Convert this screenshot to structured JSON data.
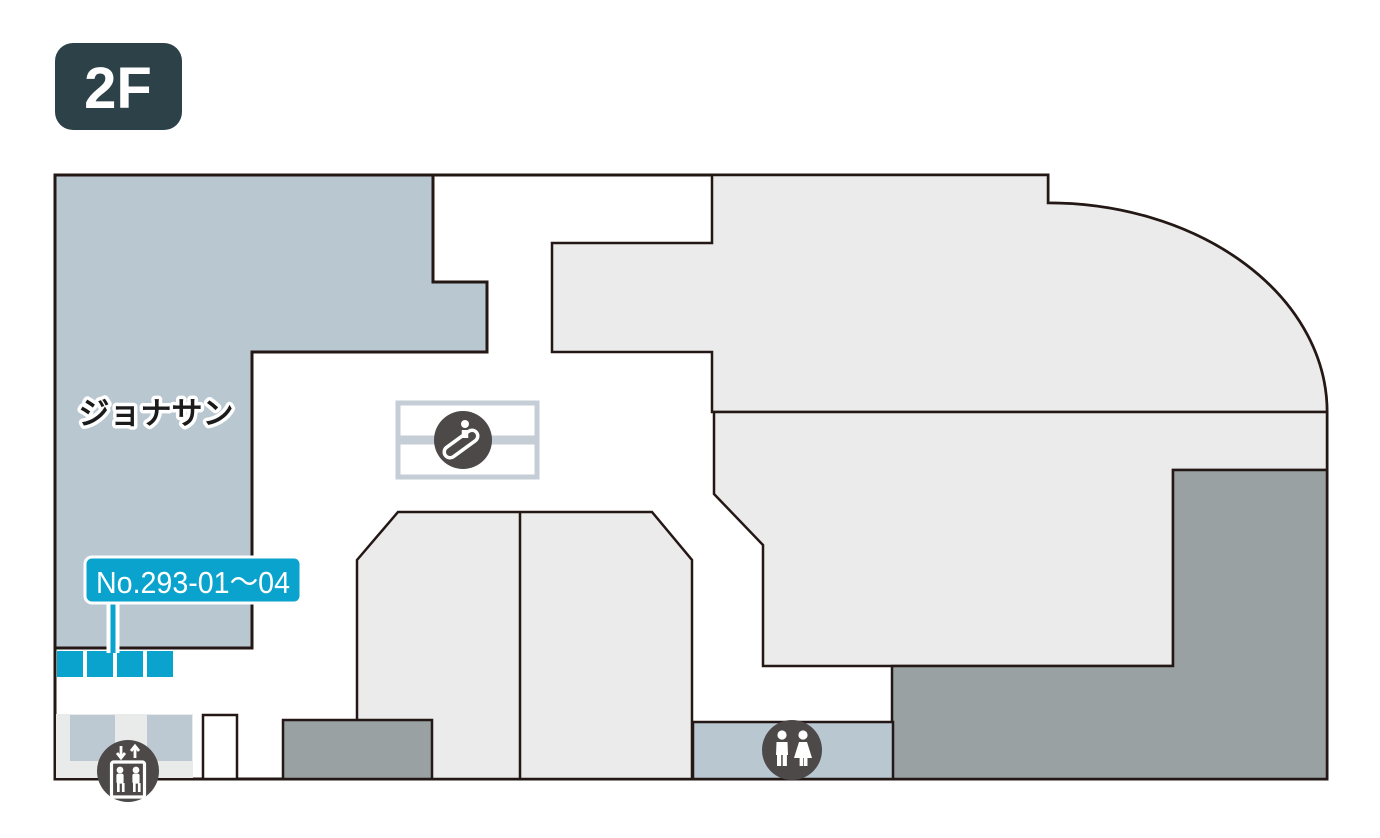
{
  "floor_badge": {
    "label": "2F"
  },
  "map": {
    "store_label": "ジョナサン",
    "unit_callout": "No.293-01〜04",
    "icons": [
      {
        "name": "escalator-icon",
        "meaning": "escalator"
      },
      {
        "name": "elevator-icon",
        "meaning": "elevator"
      },
      {
        "name": "restroom-icon",
        "meaning": "restroom"
      }
    ],
    "colors": {
      "store_area_fill": "#b9c7d1",
      "tenant_area_fill": "#ebebeb",
      "backyard_area_fill": "#99a1a2",
      "elevator_hall_fill": "#e9eaea",
      "elevator_shaft_fill": "#bcc9d3",
      "accent_cyan": "#0aa3cd",
      "outline": "#231815",
      "badge_background": "#2d4149",
      "icon_background": "#4c4948",
      "escalator_outline": "#c5ced7"
    }
  }
}
